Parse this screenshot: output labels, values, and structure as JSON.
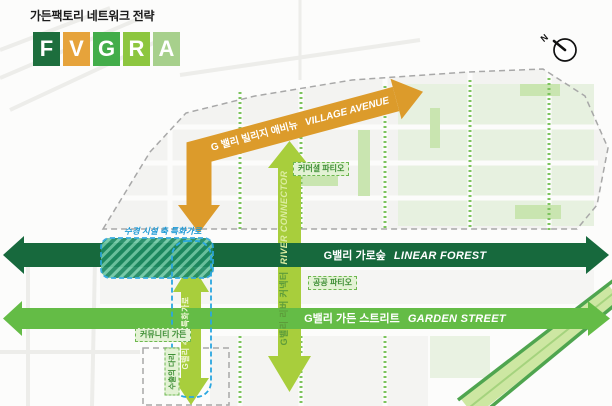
{
  "title": "가든팩토리 네트워크 전략",
  "logo": {
    "letters": [
      {
        "char": "F",
        "color": "#1d6e3d"
      },
      {
        "char": "V",
        "color": "#e6a33b"
      },
      {
        "char": "G",
        "color": "#43ad4a"
      },
      {
        "char": "R",
        "color": "#8dc63f"
      },
      {
        "char": "A",
        "color": "#a7d08c"
      }
    ]
  },
  "compass": {
    "label": "N"
  },
  "arrows": {
    "village_avenue": {
      "label_ko": "G 밸리 빌리지 애비뉴",
      "label_en": "VILLAGE AVENUE",
      "color": "#dc9b2b"
    },
    "linear_forest": {
      "label_ko": "G밸리 가로숲",
      "label_en": "LINEAR FOREST",
      "color": "#17693d"
    },
    "garden_street": {
      "label_ko": "G밸리 가든 스트리트",
      "label_en": "GARDEN STREET",
      "color": "#64bc46"
    },
    "river_connector": {
      "label_ko": "G밸리 리버 커넥터",
      "label_en": "RIVER CONNECTOR",
      "color": "#a8ce3c"
    },
    "waterfront_axis": {
      "label_ko": "G밸리 수변 특화가로",
      "color": "#a8ce3c"
    }
  },
  "annotations": {
    "water_feature_axis": "수경 시설 축 특화가로",
    "commercial_patio": "커머셜 파티오",
    "public_patio": "공공 파티오",
    "community_garden": "커뮤니티 가든",
    "export_bridge": "수출의 다리"
  }
}
